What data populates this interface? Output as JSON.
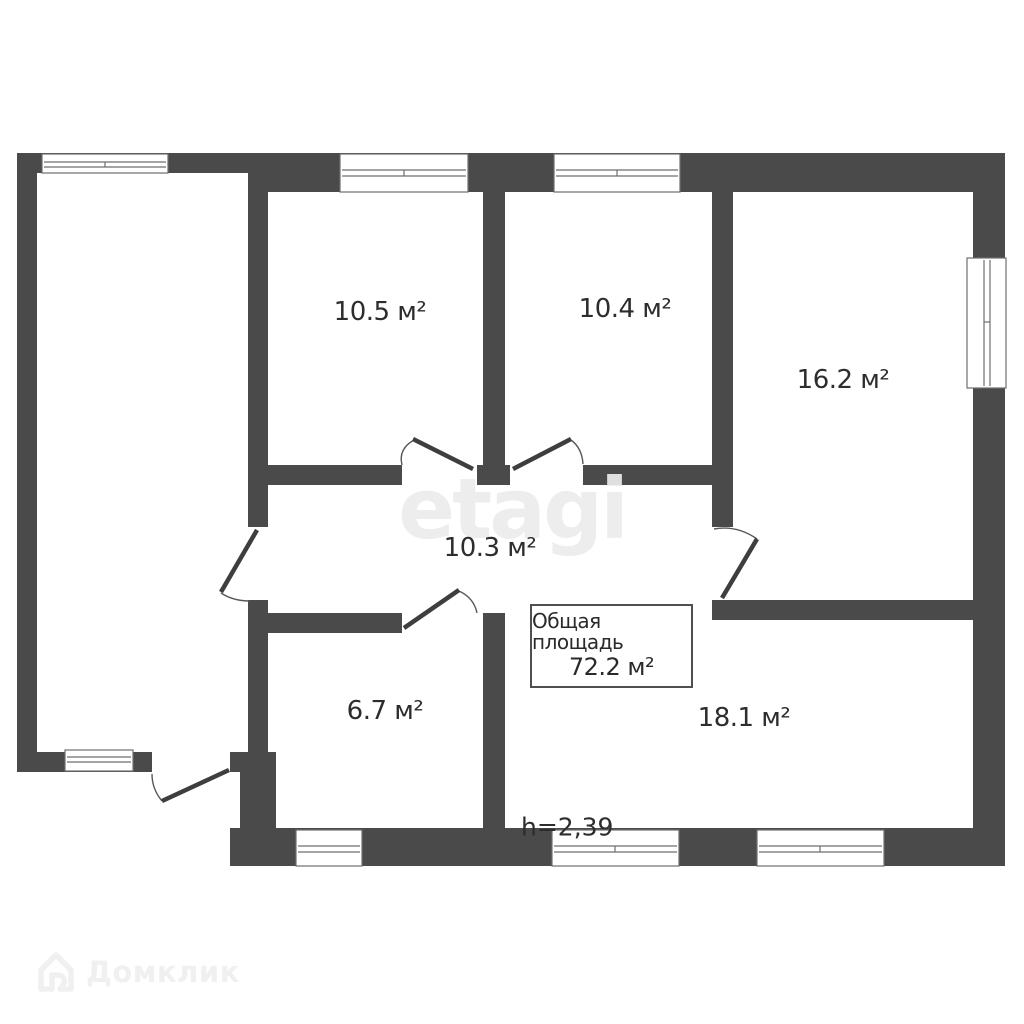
{
  "plan": {
    "rooms": [
      {
        "id": "room-10-5",
        "area": "10.5 м²"
      },
      {
        "id": "room-10-4",
        "area": "10.4 м²"
      },
      {
        "id": "room-16-2",
        "area": "16.2 м²"
      },
      {
        "id": "hallway-10-3",
        "area": "10.3 м²"
      },
      {
        "id": "room-6-7",
        "area": "6.7 м²"
      },
      {
        "id": "room-18-1",
        "area": "18.1 м²"
      }
    ],
    "total_area": {
      "label": "Общая площадь",
      "value": "72.2 м²"
    },
    "ceiling_height": "h=2,39"
  },
  "watermarks": {
    "center": "etagi",
    "brand": "Домклик"
  },
  "colors": {
    "wall": "#4a4a4a",
    "text": "#2d2d2d",
    "watermark_center": "#ebebeb",
    "watermark_brand": "#f0f0f0",
    "background": "#ffffff"
  }
}
